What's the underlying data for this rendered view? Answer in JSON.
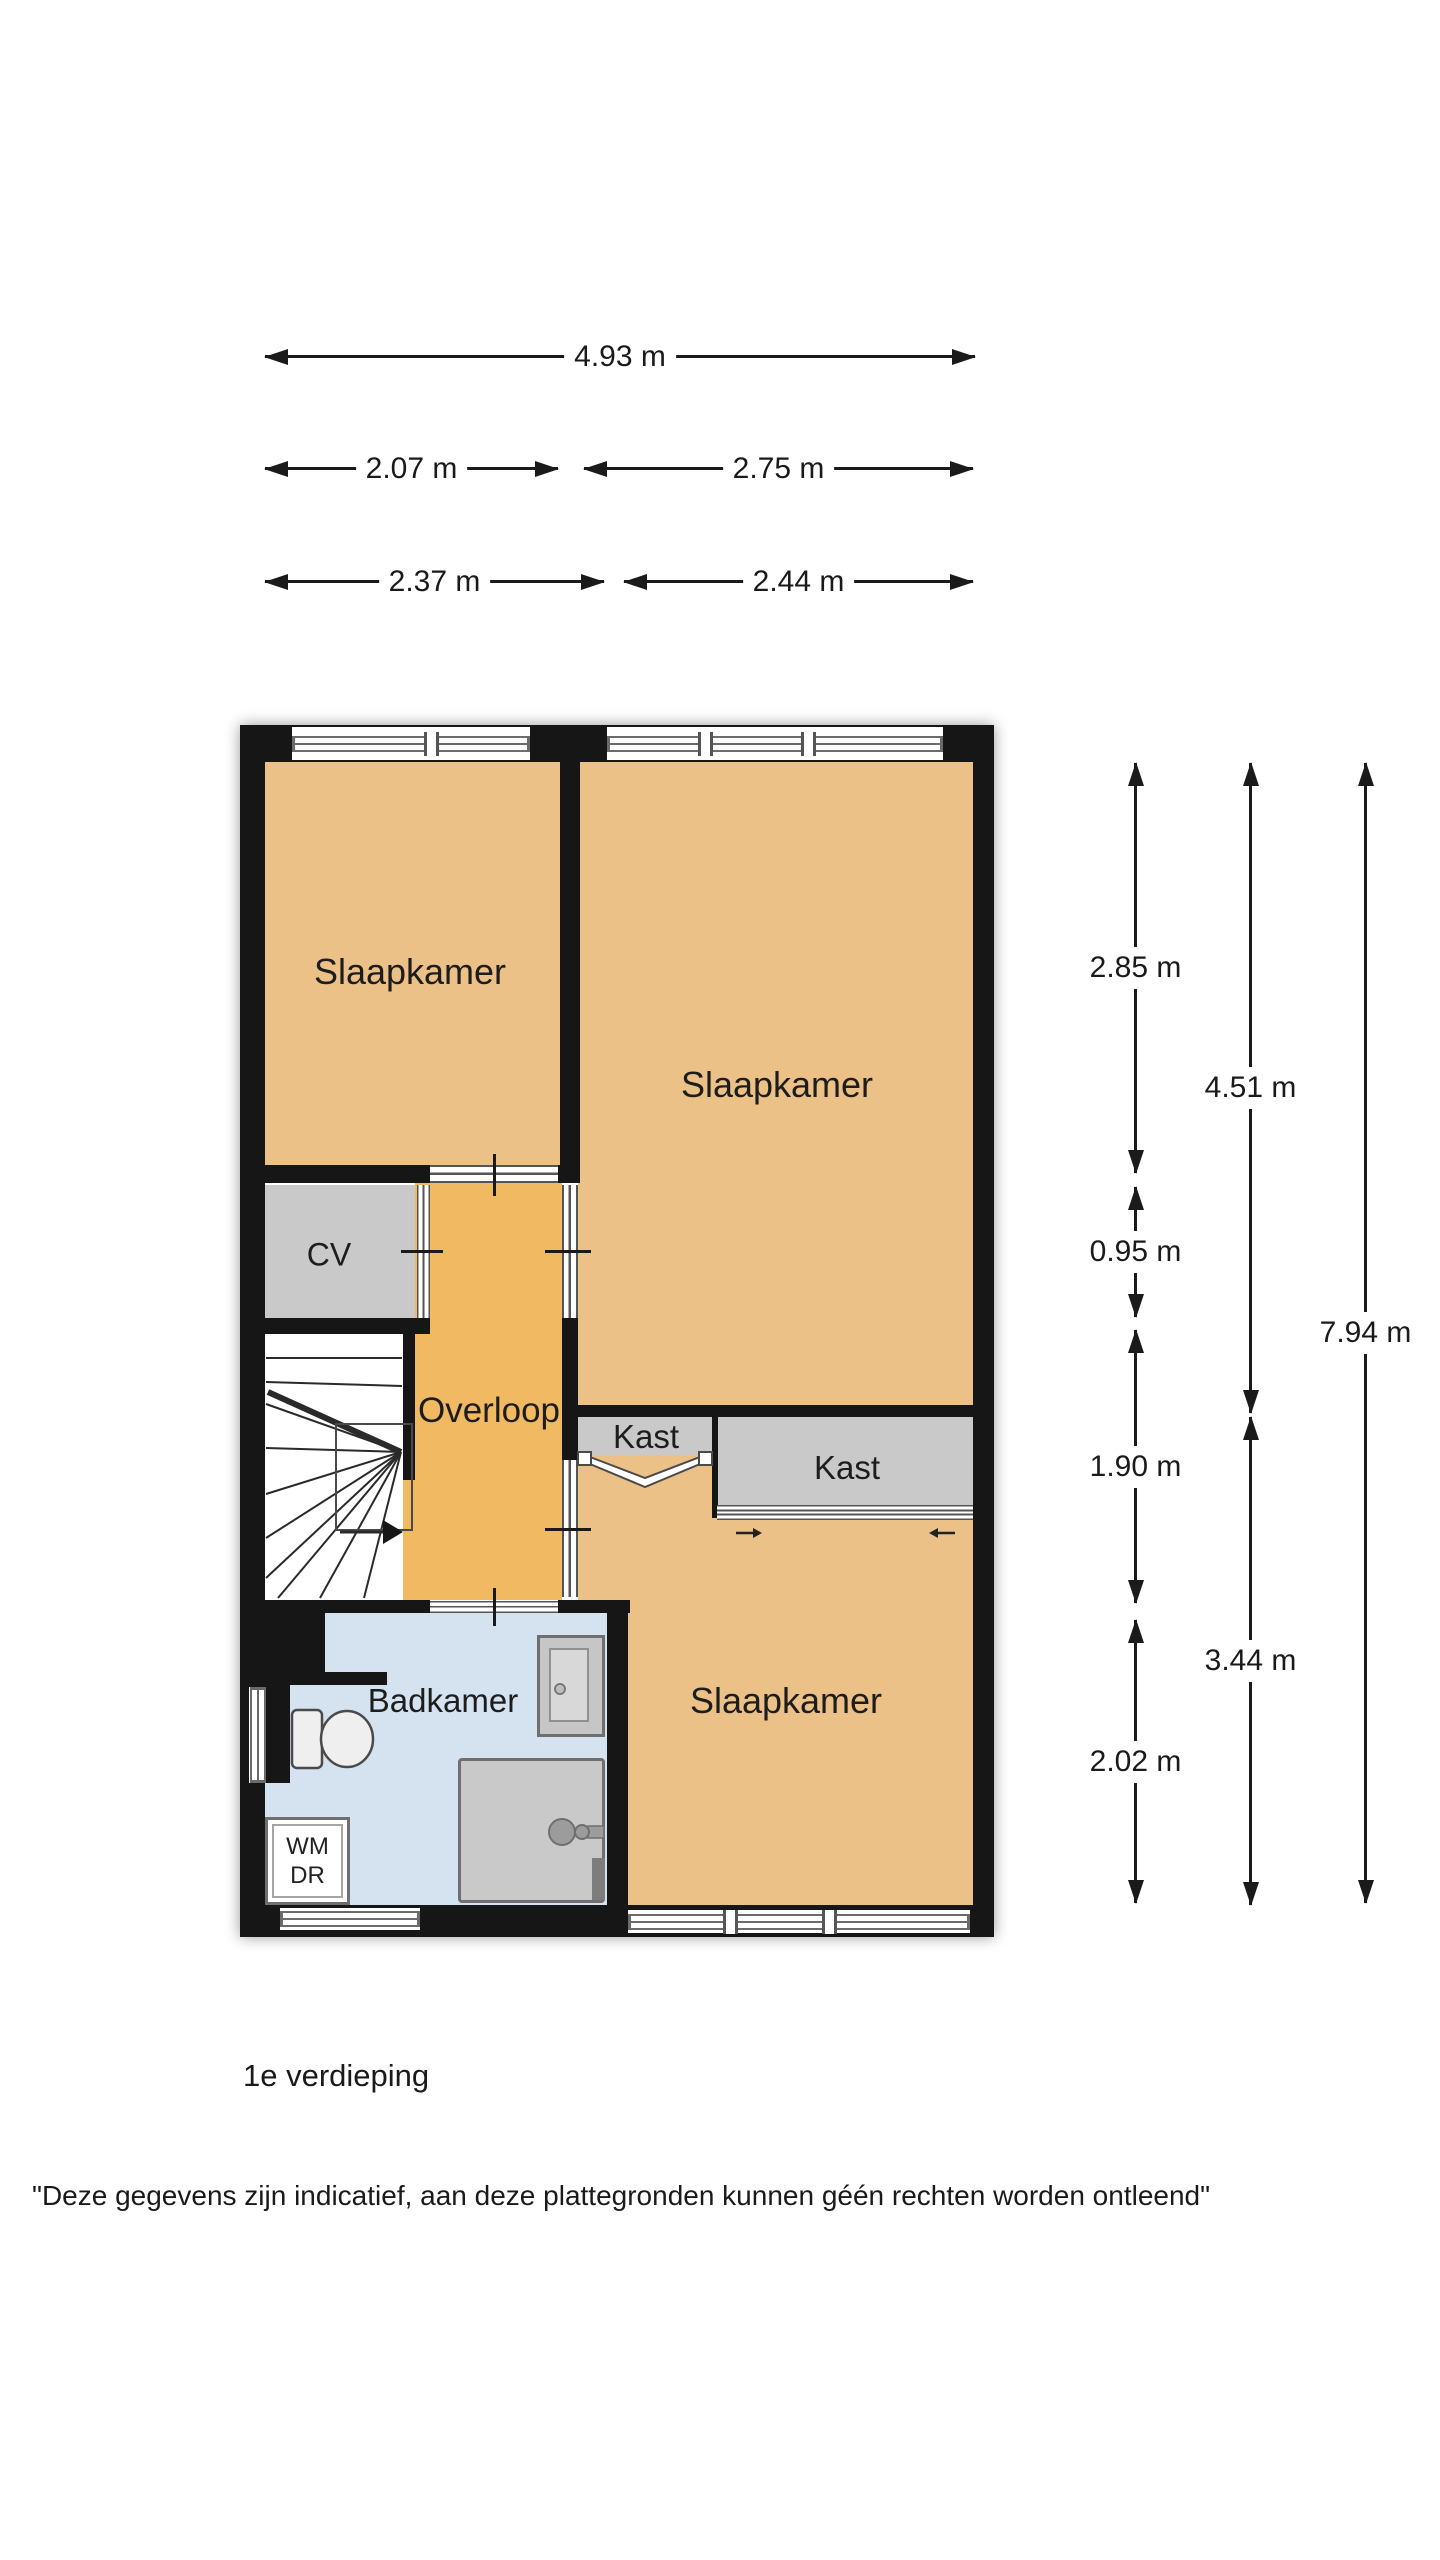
{
  "meta": {
    "floor_label": "1e verdieping",
    "disclaimer": "\"Deze gegevens zijn indicatief, aan deze plattegronden kunnen géén rechten worden ontleend\""
  },
  "colors": {
    "wall": "#161616",
    "bedroom_fill": "#ebc187",
    "hallway_fill": "#f1ba62",
    "closet_fill": "#c9c9c9",
    "bathroom_fill": "#d5e2f0",
    "background": "#ffffff"
  },
  "rooms": {
    "slaapkamer_top_left": "Slaapkamer",
    "slaapkamer_top_right": "Slaapkamer",
    "slaapkamer_bottom": "Slaapkamer",
    "cv": "CV",
    "overloop": "Overloop",
    "kast_small": "Kast",
    "kast_large": "Kast",
    "badkamer": "Badkamer",
    "wm": "WM",
    "dr": "DR"
  },
  "dimensions": {
    "horizontal": [
      {
        "label": "4.93 m"
      },
      {
        "label": "2.07 m"
      },
      {
        "label": "2.75 m"
      },
      {
        "label": "2.37 m"
      },
      {
        "label": "2.44 m"
      }
    ],
    "vertical": [
      {
        "label": "2.85 m"
      },
      {
        "label": "0.95 m"
      },
      {
        "label": "1.90 m"
      },
      {
        "label": "2.02 m"
      },
      {
        "label": "4.51 m"
      },
      {
        "label": "3.44 m"
      },
      {
        "label": "7.94 m"
      }
    ]
  }
}
